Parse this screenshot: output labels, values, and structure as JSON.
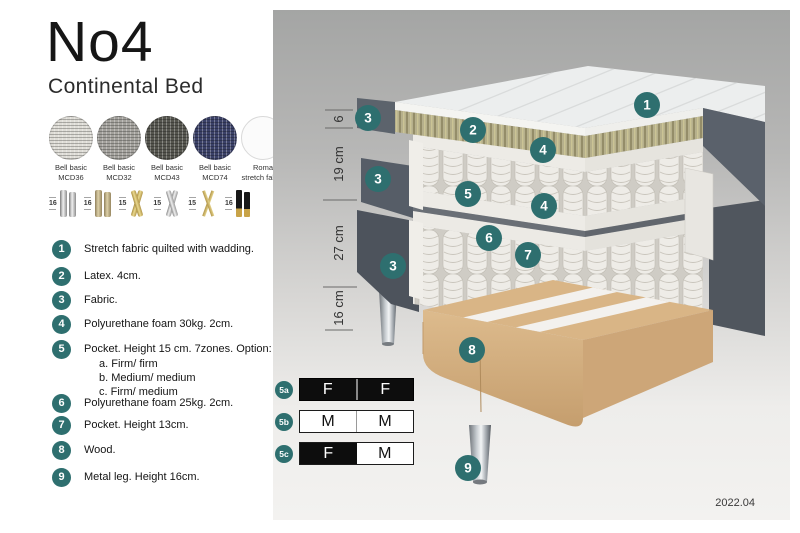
{
  "title": "No4",
  "subtitle": "Continental Bed",
  "version": "2022.04",
  "colors": {
    "accent_teal": "#2e6f6f",
    "bed_fabric_dark": "#565c66",
    "latex_layer": "#b5af8b",
    "wood": "#d9b586",
    "panel_top": "#a4a5a4",
    "panel_bottom": "#f3f2f0"
  },
  "swatches": [
    {
      "line1": "Bell basic",
      "line2": "MCD36",
      "color": "#dedcd6"
    },
    {
      "line1": "Bell basic",
      "line2": "MCD32",
      "color": "#a3a19c"
    },
    {
      "line1": "Bell basic",
      "line2": "MCD43",
      "color": "#56564f"
    },
    {
      "line1": "Bell basic",
      "line2": "MCD74",
      "color": "#3b4168"
    },
    {
      "line1": "Roma",
      "line2": "stretch fabric",
      "color": "#fbfbfb"
    }
  ],
  "legs": [
    {
      "height": "16",
      "type": "cylinder-silver"
    },
    {
      "height": "16",
      "type": "cylinder-brass"
    },
    {
      "height": "15",
      "type": "twisted-gold"
    },
    {
      "height": "15",
      "type": "twisted-silver"
    },
    {
      "height": "15",
      "type": "hairpin-gold"
    },
    {
      "height": "16",
      "type": "black-gold"
    }
  ],
  "parts": [
    {
      "num": "1",
      "text": "Stretch fabric quilted with wadding."
    },
    {
      "num": "2",
      "text": "Latex. 4cm."
    },
    {
      "num": "3",
      "text": "Fabric."
    },
    {
      "num": "4",
      "text": "Polyurethane foam 30kg. 2cm."
    },
    {
      "num": "5",
      "text": "Pocket. Height 15 cm. 7zones. Option:",
      "options": [
        "a. Firm/ firm",
        "b. Medium/ medium",
        "c. Firm/ medium"
      ]
    },
    {
      "num": "6",
      "text": "Polyurethane foam 25kg. 2cm."
    },
    {
      "num": "7",
      "text": "Pocket. Height 13cm."
    },
    {
      "num": "8",
      "text": "Wood."
    },
    {
      "num": "9",
      "text": "Metal leg. Height 16cm."
    }
  ],
  "dimensions": [
    {
      "label": "6"
    },
    {
      "label": "19 cm"
    },
    {
      "label": "27 cm"
    },
    {
      "label": "16 cm"
    }
  ],
  "callouts": {
    "c1": "1",
    "c2": "2",
    "c3": "3",
    "c4": "4",
    "c5": "5",
    "c6": "6",
    "c7": "7",
    "c8": "8",
    "c9": "9"
  },
  "firmness": [
    {
      "id": "5a",
      "left": "F",
      "right": "F",
      "left_style": "dark",
      "right_style": "dark"
    },
    {
      "id": "5b",
      "left": "M",
      "right": "M",
      "left_style": "light",
      "right_style": "light"
    },
    {
      "id": "5c",
      "left": "F",
      "right": "M",
      "left_style": "dark",
      "right_style": "light"
    }
  ]
}
